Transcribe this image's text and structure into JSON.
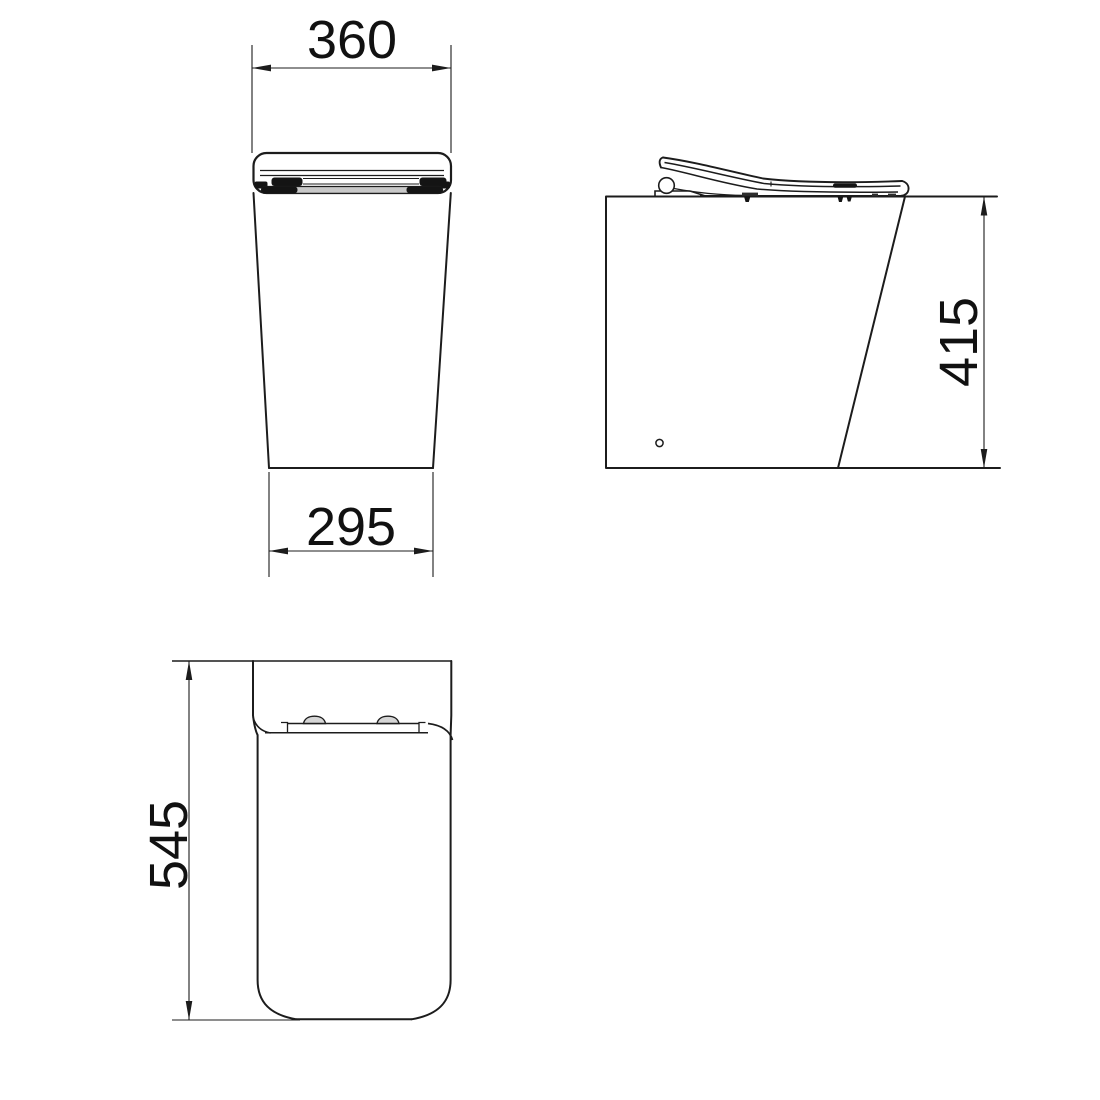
{
  "drawing": {
    "dimensions": {
      "front_top_width": "360",
      "front_bottom_width": "295",
      "side_height": "415",
      "rear_height": "545"
    },
    "colors": {
      "line": "#1c1c1c",
      "background": "#ffffff",
      "shading_grey": "#c9c9c9"
    }
  }
}
